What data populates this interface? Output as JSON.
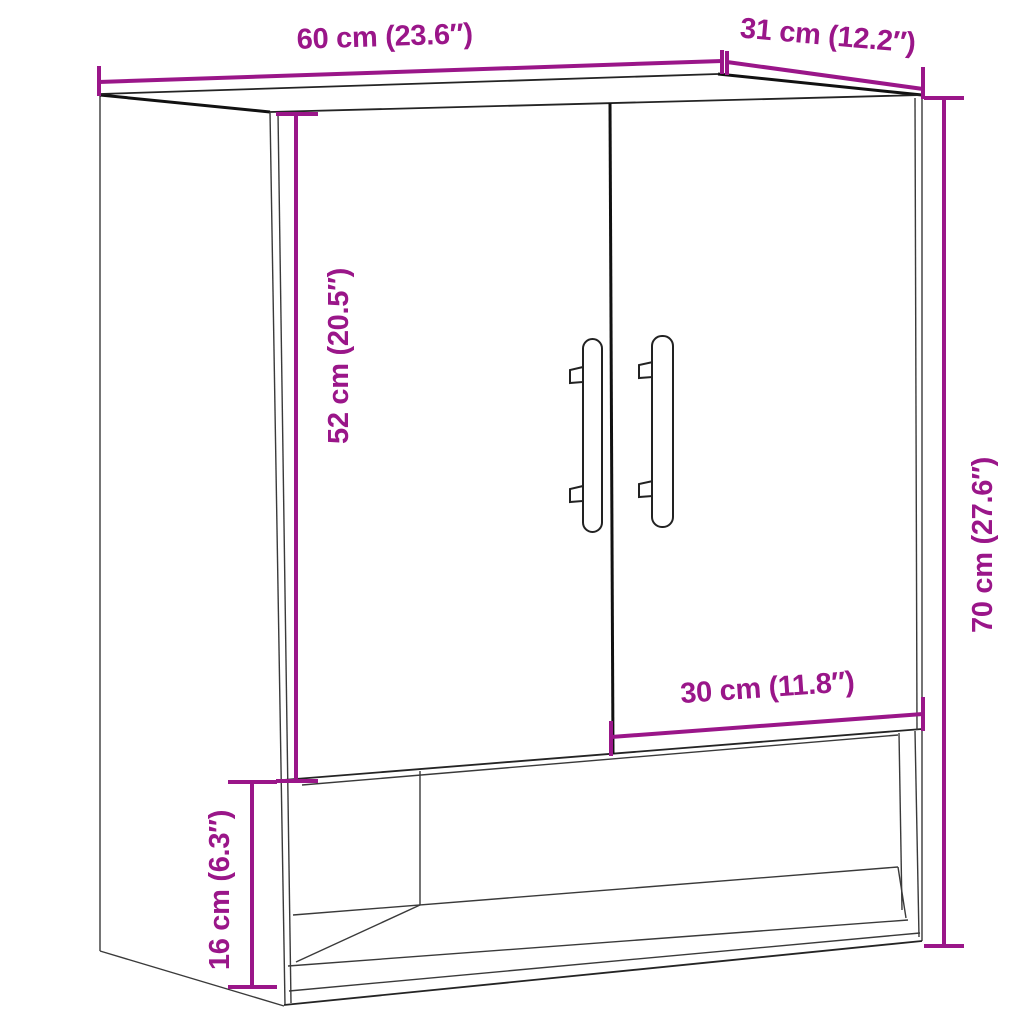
{
  "diagram": {
    "subject": "wall cabinet with two doors and open bottom shelf",
    "colors": {
      "dimension_accent": "#9A1689",
      "outline": "#1e1e1e",
      "background": "#ffffff"
    },
    "dimensions": {
      "width": {
        "label": "60 cm (23.6″)",
        "cm": 60,
        "inches": 23.6
      },
      "depth": {
        "label": "31 cm (12.2″)",
        "cm": 31,
        "inches": 12.2
      },
      "door_height": {
        "label": "52 cm (20.5″)",
        "cm": 52,
        "inches": 20.5
      },
      "height": {
        "label": "70 cm (27.6″)",
        "cm": 70,
        "inches": 27.6
      },
      "door_width": {
        "label": "30 cm (11.8″)",
        "cm": 30,
        "inches": 11.8
      },
      "shelf_height": {
        "label": "16 cm (6.3″)",
        "cm": 16,
        "inches": 6.3
      }
    }
  }
}
